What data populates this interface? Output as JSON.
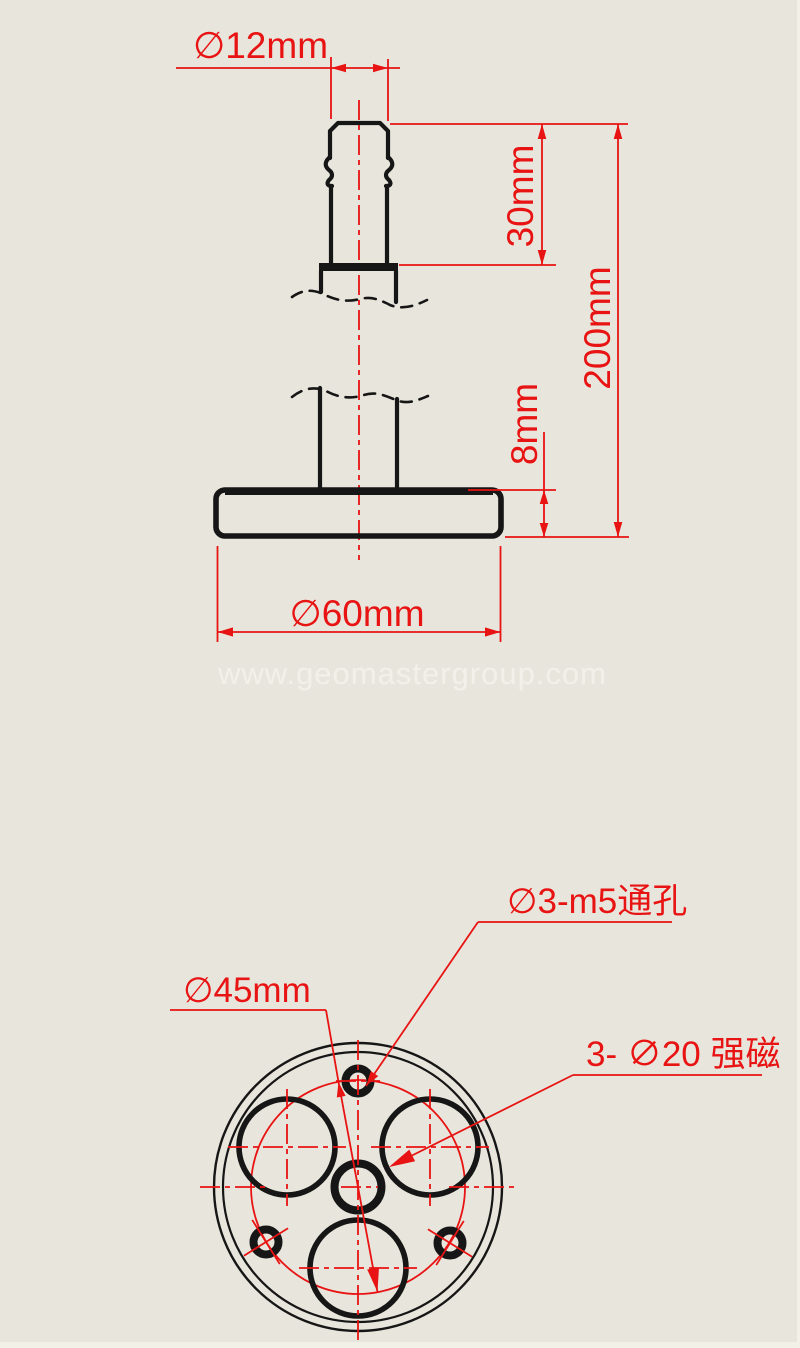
{
  "drawing": {
    "watermark": "www.geomastergroup.com",
    "side_view": {
      "stud_diameter": "∅12mm",
      "stud_length": "30mm",
      "total_height": "200mm",
      "base_thickness": "8mm",
      "base_diameter": "∅60mm"
    },
    "bottom_view": {
      "thread_holes_label": "∅3-m5通孔",
      "bolt_circle_label": "∅45mm",
      "magnets_label": "3- ∅20 强磁"
    },
    "colors": {
      "background": "#e8e6dc",
      "dimension_red": "#e81313",
      "outline_black": "#161616",
      "watermark": "#f3f1ea"
    }
  }
}
